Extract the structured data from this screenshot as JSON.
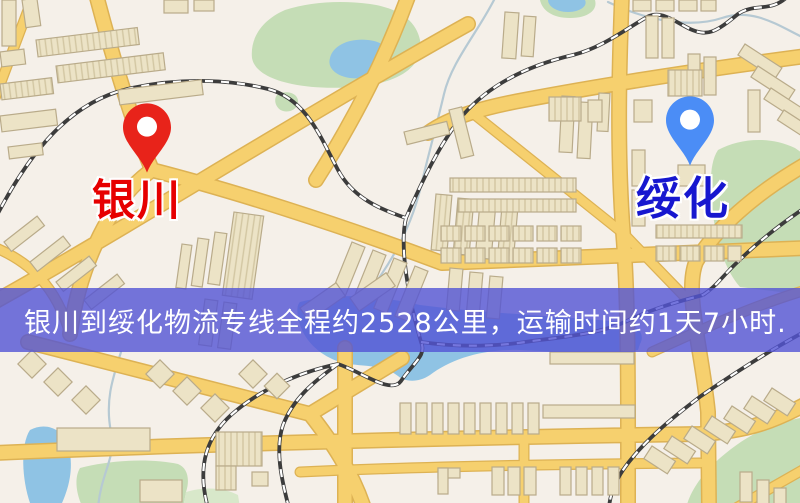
{
  "map": {
    "markers": [
      {
        "id": "origin",
        "label": "银川"
      },
      {
        "id": "destination",
        "label": "绥化"
      }
    ],
    "banner": {
      "text": "银川到绥化物流专线全程约2528公里，运输时间约1天7小时."
    },
    "colors": {
      "background": "#f5f0e9",
      "road": "#f6d06e",
      "road_casing": "#ddb254",
      "water": "#8fc3e4",
      "park": "#c5ddb6",
      "park_light": "#d8e8ca",
      "building": "#ece3c6",
      "building_stroke": "#b9ab8a",
      "railway": "#3c3c3c",
      "river": "#b6c9d3",
      "banner_bg": "rgba(82,84,212,0.8)",
      "banner_text": "#ffffff",
      "pin_origin": "#e8231a",
      "pin_destination": "#4b8df6",
      "label_origin": "#e60000",
      "label_destination": "#1717cf"
    }
  }
}
